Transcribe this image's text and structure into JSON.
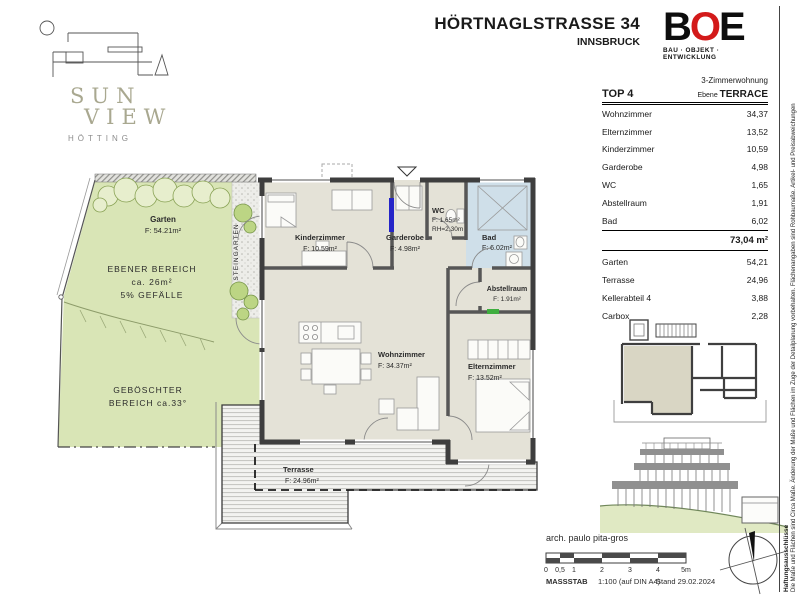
{
  "header": {
    "title": "HÖRTNAGLSTRASSE 34",
    "city": "INNSBRUCK",
    "logo": {
      "line1": "SUN",
      "line2": "VIEW",
      "line3": "HÖTTING"
    },
    "boe": {
      "b": "B",
      "o": "O",
      "e": "E",
      "tagline": "BAU · OBJEKT · ENTWICKLUNG",
      "accent": "#d31a1a"
    }
  },
  "unit_table": {
    "type_label": "3-Zimmerwohnung",
    "top_label": "TOP 4",
    "level_label": "Ebene ",
    "level_value": "TERRACE",
    "rooms": [
      {
        "label": "Wohnzimmer",
        "value": "34,37"
      },
      {
        "label": "Elternzimmer",
        "value": "13,52"
      },
      {
        "label": "Kinderzimmer",
        "value": "10,59"
      },
      {
        "label": "Garderobe",
        "value": "4,98"
      },
      {
        "label": "WC",
        "value": "1,65"
      },
      {
        "label": "Abstellraum",
        "value": "1,91"
      },
      {
        "label": "Bad",
        "value": "6,02"
      }
    ],
    "total": "73,04 m²",
    "extras": [
      {
        "label": "Garten",
        "value": "54,21"
      },
      {
        "label": "Terrasse",
        "value": "24,96"
      },
      {
        "label": "Kellerabteil 4",
        "value": "3,88"
      },
      {
        "label": "Carbox",
        "value": "2,28"
      }
    ]
  },
  "plan": {
    "rooms": [
      {
        "name": "Kinderzimmer",
        "area": "F: 10.59m²"
      },
      {
        "name": "Garderobe",
        "area": "F: 4.98m²"
      },
      {
        "name": "WC",
        "area": "F: 1.65m²",
        "height": "RH=2,30m"
      },
      {
        "name": "Bad",
        "area": "F: 6.02m²"
      },
      {
        "name": "Abstellraum",
        "area": "F: 1.91m²"
      },
      {
        "name": "Wohnzimmer",
        "area": "F: 34.37m²"
      },
      {
        "name": "Elternzimmer",
        "area": "F: 13.52m²"
      },
      {
        "name": "Terrasse",
        "area": "F: 24.96m²"
      }
    ],
    "garden": {
      "name": "Garten",
      "area": "F: 54.21m²",
      "flat1": "EBENER BEREICH",
      "flat2": "ca. 26m²",
      "flat3": "5% GEFÄLLE",
      "slope1": "GEBÖSCHTER",
      "slope2": "BEREICH  ca.33°",
      "strip": "STEINGARTEN"
    }
  },
  "footer": {
    "architect": "arch. paulo pita-gros",
    "scale_ticks": [
      "0",
      "0,5",
      "1",
      "2",
      "3",
      "4",
      "5m"
    ],
    "masstab": {
      "label": "MASSSTAB",
      "value": "1:100 (auf DIN A4)",
      "date": "Stand 29.02.2024"
    }
  },
  "disclaimer": {
    "title": "Haftungsausschlüsse",
    "text": "Die Maße und Flächen sind Circa Maße. Änderung der Maße und Flächen im Zuge der Detailplanung vorbehalten. Flächenangaben sind Rohbaumaße. Artikel- und Preisabweichungen"
  }
}
